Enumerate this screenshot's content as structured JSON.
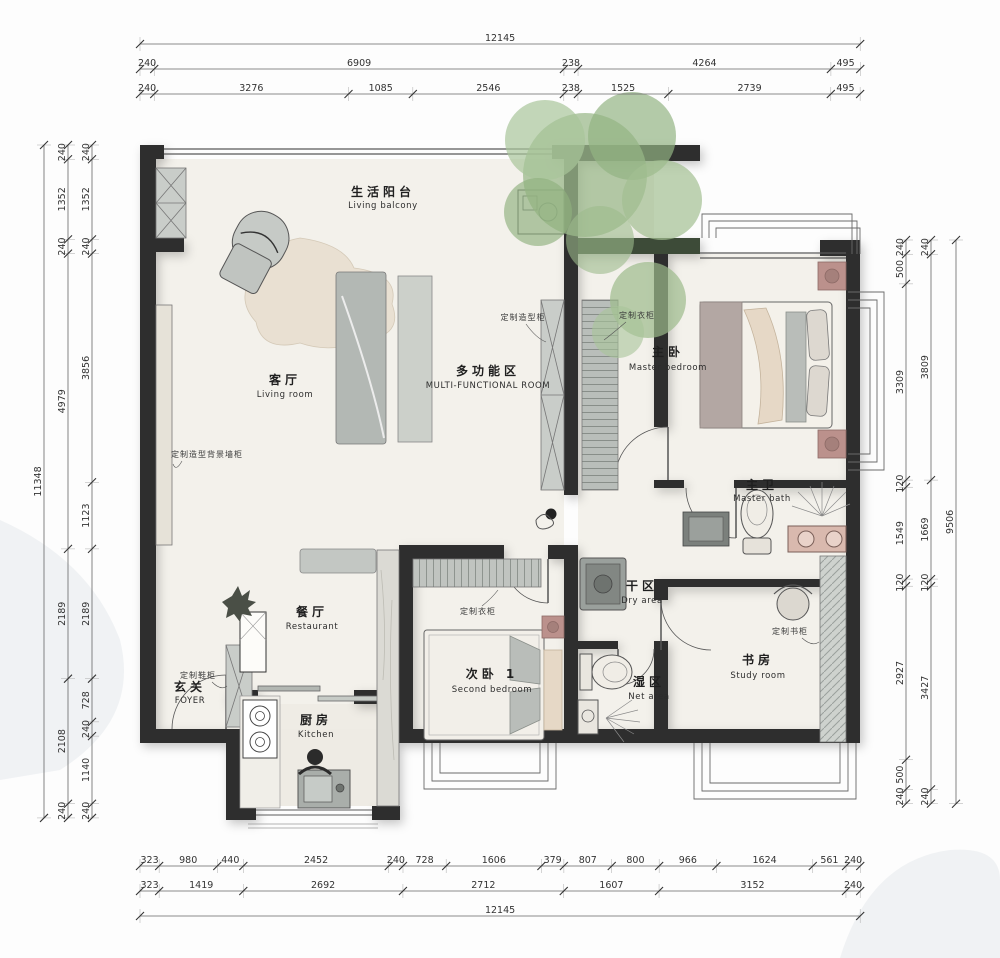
{
  "drawing": {
    "type": "residential floor plan",
    "units": "mm"
  },
  "rooms": [
    {
      "id": "living-balcony",
      "zh": "生活阳台",
      "en": "Living balcony"
    },
    {
      "id": "living-room",
      "zh": "客厅",
      "en": "Living room"
    },
    {
      "id": "multi-functional",
      "zh": "多功能区",
      "en": "MULTI-FUNCTIONAL ROOM"
    },
    {
      "id": "master-bedroom",
      "zh": "主卧",
      "en": "Master bedroom"
    },
    {
      "id": "master-bath",
      "zh": "主卫",
      "en": "Master bath"
    },
    {
      "id": "dry-area",
      "zh": "干区",
      "en": "Dry area"
    },
    {
      "id": "wet-area",
      "zh": "湿区",
      "en": "Net area"
    },
    {
      "id": "study-room",
      "zh": "书房",
      "en": "Study room"
    },
    {
      "id": "second-bedroom",
      "zh": "次卧 1",
      "en": "Second bedroom"
    },
    {
      "id": "restaurant",
      "zh": "餐厅",
      "en": "Restaurant"
    },
    {
      "id": "kitchen",
      "zh": "厨房",
      "en": "Kitchen"
    },
    {
      "id": "foyer",
      "zh": "玄关",
      "en": "FOYER"
    }
  ],
  "cabinet_labels": [
    {
      "id": "custom-shaped-cabinet",
      "text": "定制造型柜"
    },
    {
      "id": "custom-wardrobe-corridor",
      "text": "定制衣柜"
    },
    {
      "id": "custom-background-wall-cabinet",
      "text": "定制造型背景墙柜"
    },
    {
      "id": "custom-wardrobe-bedroom2",
      "text": "定制衣柜"
    },
    {
      "id": "custom-shoe-cabinet",
      "text": "定制鞋柜"
    },
    {
      "id": "custom-bookcase",
      "text": "定制书柜"
    }
  ],
  "dimensions": {
    "top": [
      [
        12145
      ],
      [
        240,
        6909,
        238,
        4264,
        495
      ],
      [
        240,
        3276,
        1085,
        2546,
        238,
        1525,
        2739,
        495
      ]
    ],
    "bottom": [
      [
        323,
        980,
        440,
        2452,
        240,
        728,
        1606,
        379,
        807,
        800,
        966,
        1624,
        561,
        240
      ],
      [
        323,
        1419,
        2692,
        2712,
        1607,
        3152,
        240
      ],
      [
        12145
      ]
    ],
    "left": [
      [
        11348
      ],
      [
        240,
        1352,
        240,
        4979,
        2189,
        2108,
        240
      ],
      [
        240,
        1352,
        240,
        3856,
        1123,
        2189,
        728,
        240,
        1140,
        240
      ]
    ],
    "right": [
      [
        240,
        500,
        3309,
        120,
        1549,
        120,
        2927,
        500,
        240
      ],
      [
        240,
        3809,
        1669,
        120,
        3427,
        240
      ],
      [
        9506
      ]
    ]
  },
  "colors": {
    "wall": "#2d2d2d",
    "floor": "#f3f1eb",
    "furniture_gray": "#b9bdb9",
    "accent_pink": "#bb918c",
    "rug": "#e9e0d2",
    "tree": "#9cba8c",
    "dim_line": "#666"
  }
}
